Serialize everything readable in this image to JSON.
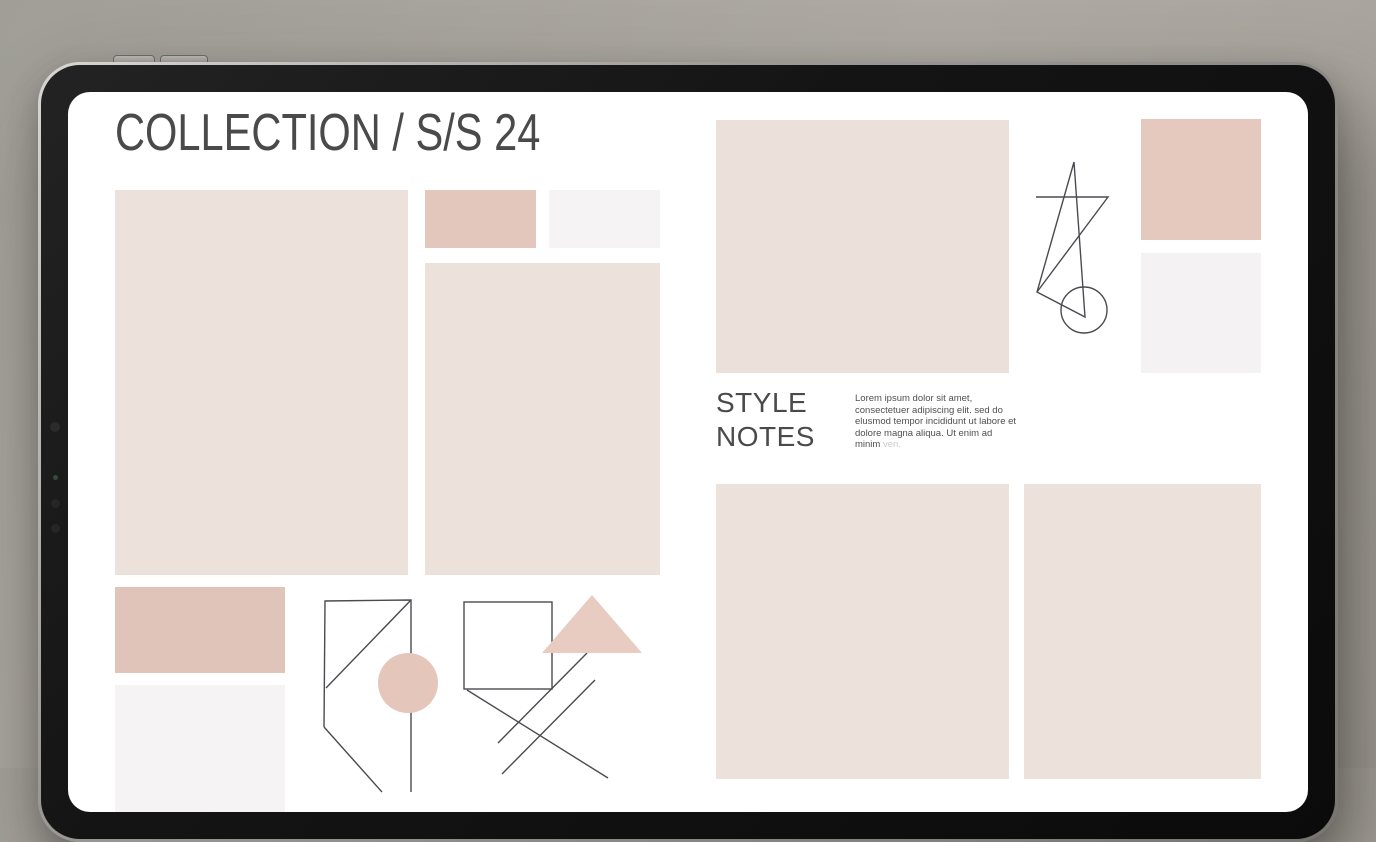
{
  "theme": {
    "background": "#a8a49d",
    "bezel": "#141414",
    "screen": "#ffffff",
    "line": "#4c4a50",
    "geo_circle": "#e5c6bb",
    "geo_triangle": "#e8ccc1",
    "text_dark": "#4a4a4a",
    "text_body": "#4f4f4f",
    "text_faint": "#cfc9c6"
  },
  "header": {
    "title": "COLLECTION / S/S 24"
  },
  "style_notes": {
    "heading_lines": [
      "STYLE",
      "NOTES"
    ],
    "body": "Lorem ipsum dolor sit amet, consectetuer adipiscing elit. sed do elusmod tempor incididunt ut labore et dolore magna aliqua. Ut enim ad minim",
    "body_trailing_faint": "ven."
  },
  "swatches": [
    {
      "id": "left-large",
      "color": "#ece1db"
    },
    {
      "id": "mid-pink",
      "color": "#e3c7bc"
    },
    {
      "id": "mid-gray",
      "color": "#f5f3f4"
    },
    {
      "id": "mid-tall",
      "color": "#ece1db"
    },
    {
      "id": "left-pink",
      "color": "#e0c3b9"
    },
    {
      "id": "left-gray",
      "color": "#f5f3f4"
    },
    {
      "id": "right-large",
      "color": "#ebe0da"
    },
    {
      "id": "tr-pink",
      "color": "#e5c9be"
    },
    {
      "id": "tr-gray",
      "color": "#f4f2f3"
    },
    {
      "id": "bottom-left",
      "color": "#ece1db"
    },
    {
      "id": "bottom-right",
      "color": "#ece1db"
    }
  ],
  "line_art": {
    "figures": [
      "pentagon-with-circle",
      "square-triangle-cross-lines",
      "abstract-star-with-circle"
    ]
  }
}
